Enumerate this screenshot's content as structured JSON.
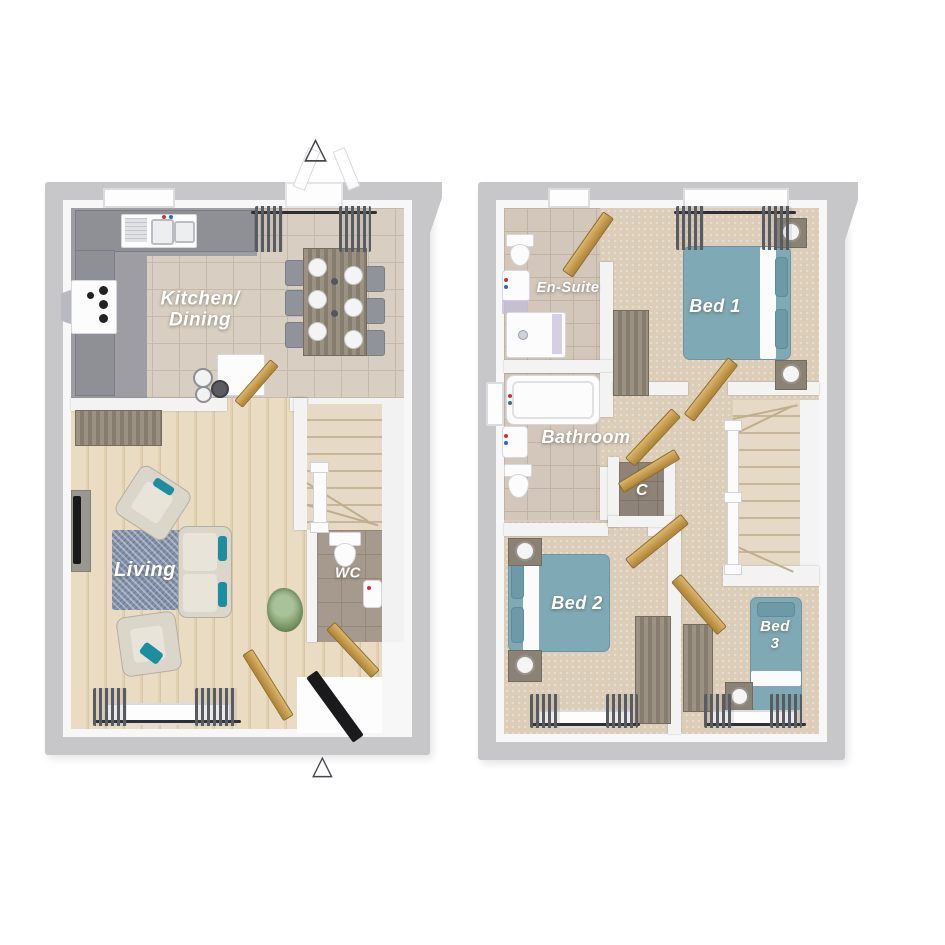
{
  "icons": {
    "entry_marker": "△"
  },
  "colors": {
    "wall": "#c7c7ca",
    "partition": "#f3f3f4",
    "tile-kitchen": "#d8cec2",
    "tile-bath": "#d2c7ba",
    "wood-floor": "#e6d7bd",
    "carpet": "#dccdb9",
    "kitchen-gray": "#9d9da3",
    "counter": "#8f8f96",
    "bed-teal": "#7fa9b4",
    "cushion-teal": "#1d8da0",
    "rug": "#8191a9",
    "door-tan": "#c9a257",
    "front-door": "#1a1a1d",
    "label": "#ffffff"
  },
  "ground": {
    "kitchen_dining": "Kitchen/\nDining",
    "living": "Living",
    "wc": "WC"
  },
  "first": {
    "en_suite": "En-Suite",
    "bed1": "Bed 1",
    "bathroom": "Bathroom",
    "cupboard": "C",
    "bed2": "Bed 2",
    "bed3": "Bed\n3"
  }
}
